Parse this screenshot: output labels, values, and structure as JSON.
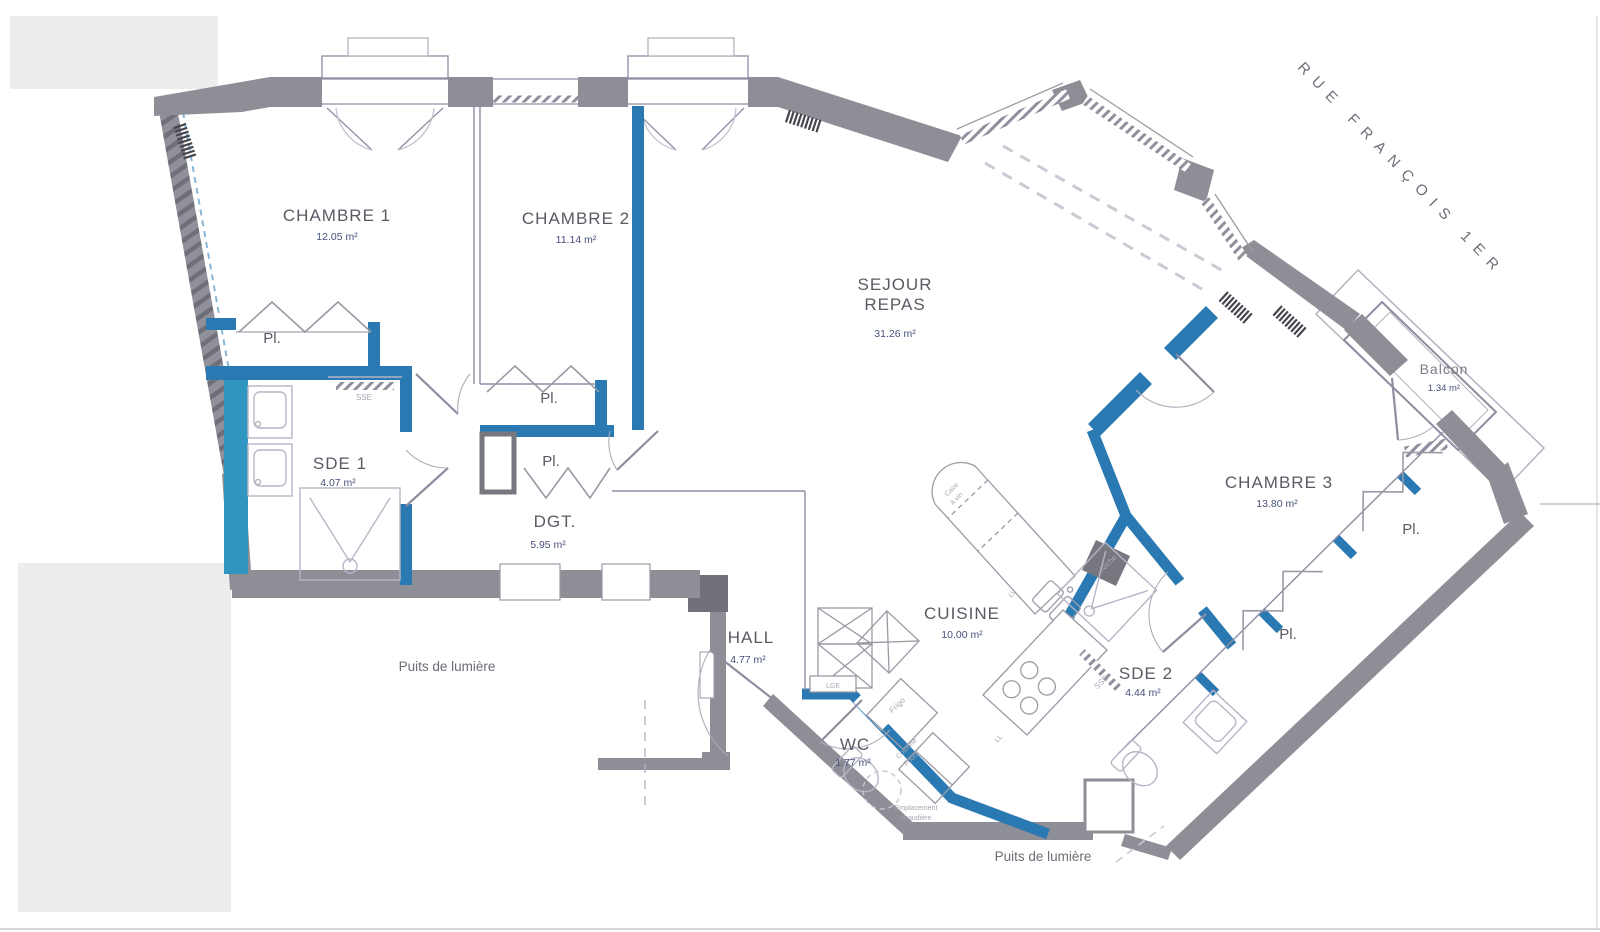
{
  "plan": {
    "street": {
      "label": "RUE FRANÇOIS 1ER"
    },
    "rooms": {
      "chambre1": {
        "name": "CHAMBRE 1",
        "area": "12.05 m²"
      },
      "chambre2": {
        "name": "CHAMBRE 2",
        "area": "11.14 m²"
      },
      "sejour": {
        "name_line1": "SEJOUR",
        "name_line2": "REPAS",
        "area": "31.26 m²"
      },
      "sde1": {
        "name": "SDE 1",
        "area": "4.07 m²"
      },
      "dgt": {
        "name": "DGT.",
        "area": "5.95 m²"
      },
      "hall": {
        "name": "HALL",
        "area": "4.77 m²"
      },
      "cuisine": {
        "name": "CUISINE",
        "area": "10.00 m²"
      },
      "wc": {
        "name": "WC",
        "area": "1.77 m²"
      },
      "sde2": {
        "name": "SDE 2",
        "area": "4.44 m²"
      },
      "chambre3": {
        "name": "CHAMBRE 3",
        "area": "13.80 m²"
      },
      "balcon": {
        "name": "Balcon",
        "area": "1.34 m²"
      }
    },
    "closets": {
      "label": "Pl."
    },
    "annotations": {
      "light_well": "Puits de lumière",
      "sse": "SSE",
      "niche": "Niche",
      "cave_line1": "Cave",
      "cave_line2": "à vin",
      "frigo": "Frigo",
      "colonne_line1": "Colonne",
      "colonne_line2": "Fours",
      "lv": "LV",
      "ll": "LL",
      "lge": "LGE",
      "boiler_line1": "Emplacement",
      "boiler_line2": "chaudière"
    },
    "colors": {
      "exterior_wall": "#8e8e96",
      "interior_wall": "#2a79b2",
      "accent_teal": "#2f96c2",
      "room_text": "#5a5a64",
      "area_text": "#46507c"
    }
  }
}
